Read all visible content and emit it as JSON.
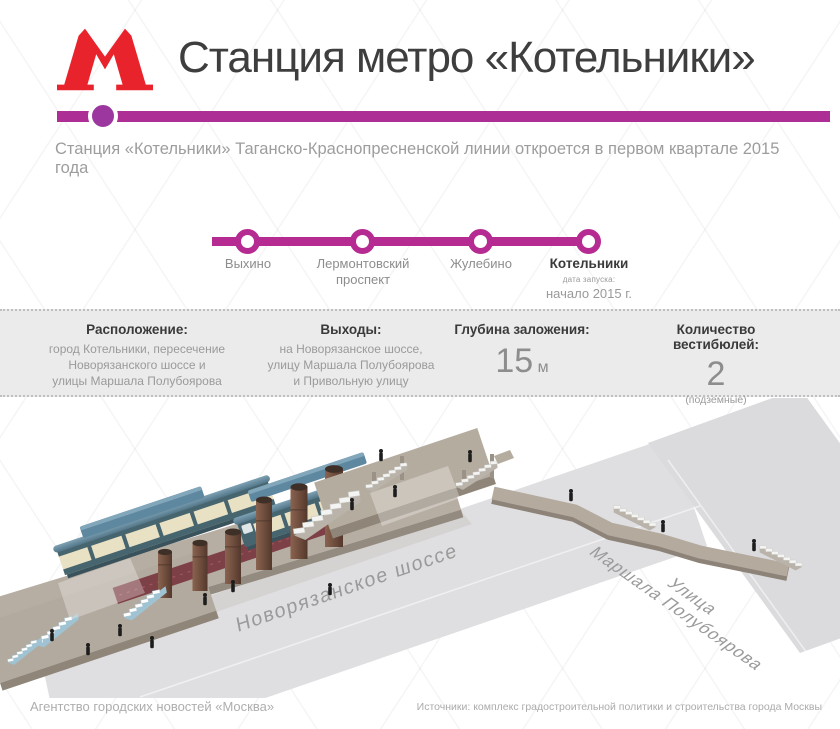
{
  "header": {
    "logo_glyph": "М",
    "title": "Станция метро «Котельники»",
    "subtitle": "Станция «Котельники» Таганско-Краснопресненской линии откроется в первом квартале 2015 года",
    "colors": {
      "metro_red": "#E8232B",
      "header_bar": "#AD2F96",
      "marker": "#9C37A0"
    }
  },
  "line_diagram": {
    "title": "Таганско-Краснопресненская линия",
    "line_color": "#B62B92",
    "stations": [
      {
        "name": "Выхино"
      },
      {
        "name": "Лермонтовский проспект"
      },
      {
        "name": "Жулебино"
      },
      {
        "name": "Котельники",
        "note_label": "дата запуска:",
        "note_value": "начало 2015 г."
      }
    ]
  },
  "info_panel": {
    "columns": [
      {
        "title": "Расположение:",
        "line1": "город Котельники, пересечение",
        "line2": "Новорязанского шоссе и",
        "line3": "улицы Маршала Полубоярова"
      },
      {
        "title": "Выходы:",
        "line1": "на Новорязанское шоссе,",
        "line2": "улицу Маршала Полубоярова",
        "line3": "и Привольную улицу"
      },
      {
        "title": "Глубина заложения:",
        "value": "15",
        "unit": "м"
      },
      {
        "title": "Количество вестибюлей:",
        "value": "2",
        "note": "(подземные)"
      }
    ]
  },
  "illustration": {
    "main_road_label": "Новорязанское шоссе",
    "cross_road_label_line1": "Улица",
    "cross_road_label_line2": "Маршала Полубоярова",
    "colors": {
      "road": "#DFDFE1",
      "cross_road": "#DBDBDE",
      "platform_base": "#B7AEA3",
      "platform_side": "#948B80",
      "platform_floor_red": "#7D4046",
      "train_frame": "#46656F",
      "train_window_band": "#ECE4C6",
      "train_roof": "#5D8195",
      "canopy": "#5E87A0",
      "chimney": "#6D4C3C",
      "walkway": "#B4AA9E",
      "people": "#1D1D1D"
    }
  },
  "footer": {
    "credit": "Агентство городских новостей «Москва»",
    "sources": "Источники: комплекс градостроительной политики и строительства города Москвы"
  }
}
